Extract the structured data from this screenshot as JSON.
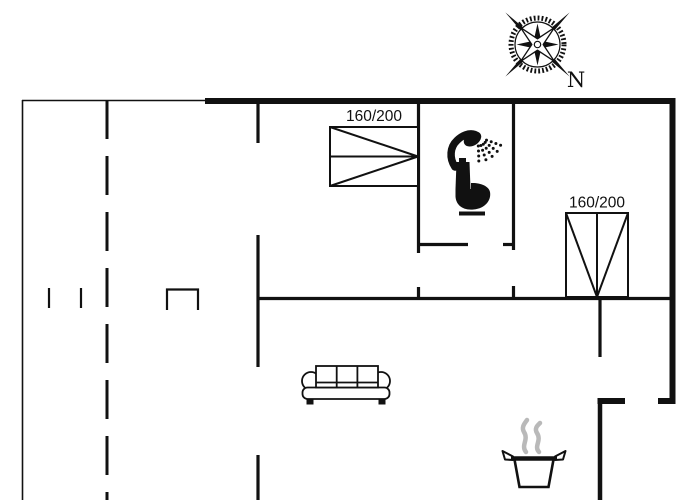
{
  "meta": {
    "background_color": "#ffffff",
    "line_color": "#111111",
    "steam_color": "#b9b9b9"
  },
  "compass": {
    "label": "N"
  },
  "beds": [
    {
      "label": "160/200"
    },
    {
      "label": "160/200"
    }
  ],
  "icons": [
    "compass-rose-icon",
    "shower-icon",
    "toilet-icon",
    "double-bed-top-icon",
    "double-bed-right-icon",
    "sofa-icon",
    "cooking-pot-icon"
  ]
}
